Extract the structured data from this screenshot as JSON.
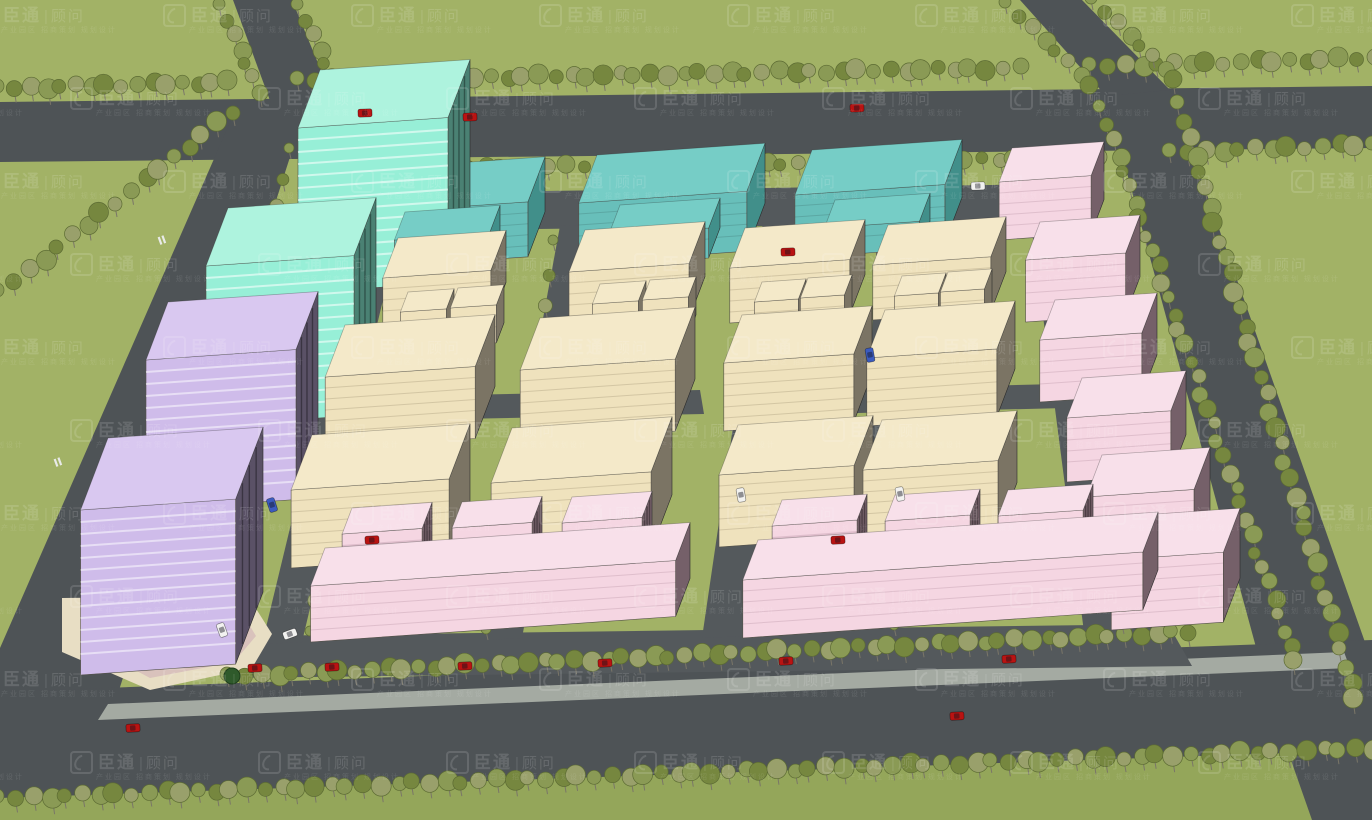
{
  "watermark": {
    "brand": "臣通",
    "divider": "|",
    "suffix": "顾问",
    "tagline": "产业园区 招商策划 规划设计",
    "logo_icon": "swoosh-logo",
    "color": "#ffffff",
    "opacity": 0.13,
    "grid": {
      "x0": -25,
      "y0": 4,
      "dx": 188,
      "dy": 83,
      "cols": 9,
      "rows": 10,
      "row_offset": 95
    }
  },
  "palette": {
    "grass": "#a2b266",
    "grassDark": "#94a65a",
    "road": "#4e5356",
    "roadInner": "#54595c",
    "sidewalk": "#a4aaa2",
    "plaza": "#e8dec4",
    "plazaPath": "#d9c2bc",
    "treeA": "#8a9a55",
    "treeB": "#76873f",
    "treeC": "#99a06b",
    "treeStroke": "#5c6b33",
    "treeDark": "#2f5a2b",
    "carRed": "#b91312",
    "carWhite": "#f2f2f0",
    "carBlue": "#3b5bbf",
    "marking": "#e8eae8"
  },
  "building_palettes": {
    "mint": {
      "top": "#aef3de",
      "front": "#97efd7",
      "side": "#4a8173",
      "line": "rgba(255,255,255,0.55)"
    },
    "teal": {
      "top": "#76cdc6",
      "front": "#68bfba",
      "side": "#418f8a",
      "line": "rgba(0,0,0,0.12)"
    },
    "cream": {
      "top": "#f4e9c9",
      "front": "#efe2bd",
      "side": "#7b7464",
      "line": "rgba(70,58,30,0.16)"
    },
    "pink": {
      "top": "#f8e0ea",
      "front": "#f5d6e2",
      "side": "#756069",
      "line": "rgba(90,50,70,0.14)"
    },
    "purple": {
      "top": "#d9c8f0",
      "front": "#cfbcea",
      "side": "#5a5166",
      "line": "rgba(255,255,255,0.5)"
    }
  },
  "roads": [
    {
      "name": "bottom-grass-strip",
      "fill": "grassDark",
      "pts": [
        [
          0,
          795
        ],
        [
          1372,
          746
        ],
        [
          1372,
          820
        ],
        [
          0,
          820
        ]
      ]
    },
    {
      "name": "top-road",
      "fill": "road",
      "pts": [
        [
          0,
          102
        ],
        [
          1372,
          86
        ],
        [
          1372,
          148
        ],
        [
          0,
          162
        ]
      ]
    },
    {
      "name": "feeder-road-left",
      "fill": "road",
      "pts": [
        [
          233,
          0
        ],
        [
          292,
          0
        ],
        [
          334,
          102
        ],
        [
          272,
          106
        ]
      ]
    },
    {
      "name": "feeder-road-right",
      "fill": "road",
      "pts": [
        [
          1020,
          0
        ],
        [
          1082,
          0
        ],
        [
          1170,
          90
        ],
        [
          1106,
          96
        ]
      ]
    },
    {
      "name": "left-perimeter-road",
      "fill": "road",
      "pts": [
        [
          238,
          104
        ],
        [
          307,
          104
        ],
        [
          112,
          712
        ],
        [
          0,
          714
        ],
        [
          0,
          648
        ]
      ]
    },
    {
      "name": "right-perimeter-road",
      "fill": "road",
      "pts": [
        [
          1106,
          96
        ],
        [
          1170,
          90
        ],
        [
          1372,
          662
        ],
        [
          1372,
          820
        ],
        [
          1312,
          820
        ],
        [
          1272,
          706
        ]
      ]
    },
    {
      "name": "bottom-road",
      "fill": "road",
      "pts": [
        [
          0,
          692
        ],
        [
          1372,
          640
        ],
        [
          1372,
          750
        ],
        [
          0,
          798
        ]
      ]
    },
    {
      "name": "bottom-sidewalk",
      "fill": "sidewalk",
      "pts": [
        [
          108,
          704
        ],
        [
          1344,
          652
        ],
        [
          1350,
          668
        ],
        [
          98,
          720
        ]
      ]
    },
    {
      "name": "inner-top-road",
      "fill": "roadInner",
      "pts": [
        [
          318,
          194
        ],
        [
          1062,
          184
        ],
        [
          1074,
          222
        ],
        [
          308,
          232
        ]
      ]
    },
    {
      "name": "inner-bottom-road",
      "fill": "roadInner",
      "pts": [
        [
          252,
          636
        ],
        [
          1168,
          624
        ],
        [
          1192,
          666
        ],
        [
          228,
          678
        ]
      ]
    },
    {
      "name": "inner-road-v1",
      "fill": "roadInner",
      "pts": [
        [
          362,
          230
        ],
        [
          400,
          228
        ],
        [
          302,
          642
        ],
        [
          262,
          644
        ]
      ]
    },
    {
      "name": "inner-road-v2",
      "fill": "roadInner",
      "pts": [
        [
          560,
          226
        ],
        [
          598,
          224
        ],
        [
          522,
          638
        ],
        [
          484,
          640
        ]
      ]
    },
    {
      "name": "inner-road-v3",
      "fill": "roadInner",
      "pts": [
        [
          763,
          222
        ],
        [
          808,
          220
        ],
        [
          747,
          636
        ],
        [
          702,
          638
        ]
      ]
    },
    {
      "name": "inner-road-v4",
      "fill": "roadInner",
      "pts": [
        [
          878,
          220
        ],
        [
          912,
          219
        ],
        [
          890,
          634
        ],
        [
          856,
          635
        ]
      ]
    },
    {
      "name": "inner-road-v5",
      "fill": "roadInner",
      "pts": [
        [
          1030,
          216
        ],
        [
          1066,
          215
        ],
        [
          1120,
          630
        ],
        [
          1084,
          632
        ]
      ]
    },
    {
      "name": "inner-road-h-left",
      "fill": "roadInner",
      "pts": [
        [
          316,
          398
        ],
        [
          700,
          390
        ],
        [
          704,
          414
        ],
        [
          310,
          422
        ]
      ]
    },
    {
      "name": "inner-road-h-right",
      "fill": "roadInner",
      "pts": [
        [
          740,
          392
        ],
        [
          1058,
          384
        ],
        [
          1066,
          408
        ],
        [
          733,
          416
        ]
      ]
    },
    {
      "name": "plaza",
      "fill": "plaza",
      "pts": [
        [
          62,
          598
        ],
        [
          248,
          596
        ],
        [
          272,
          634
        ],
        [
          252,
          668
        ],
        [
          150,
          690
        ],
        [
          62,
          652
        ]
      ]
    },
    {
      "name": "plaza-path",
      "fill": "plazaPath",
      "pts": [
        [
          90,
          610
        ],
        [
          238,
          606
        ],
        [
          256,
          636
        ],
        [
          234,
          662
        ],
        [
          150,
          678
        ],
        [
          90,
          646
        ]
      ]
    },
    {
      "name": "plaza-lawn",
      "fill": "grass",
      "pts": [
        [
          118,
          620
        ],
        [
          225,
          616
        ],
        [
          240,
          638
        ],
        [
          222,
          656
        ],
        [
          150,
          668
        ],
        [
          116,
          645
        ]
      ]
    }
  ],
  "tree_rows": [
    {
      "x1": 0,
      "y1": 88,
      "x2": 228,
      "y2": 82,
      "n": 16,
      "s": 8
    },
    {
      "x1": 300,
      "y1": 80,
      "x2": 1018,
      "y2": 68,
      "n": 46,
      "s": 8
    },
    {
      "x1": 1092,
      "y1": 66,
      "x2": 1372,
      "y2": 58,
      "n": 18,
      "s": 8
    },
    {
      "x1": 318,
      "y1": 170,
      "x2": 1098,
      "y2": 158,
      "n": 48,
      "s": 7
    },
    {
      "x1": 222,
      "y1": 6,
      "x2": 258,
      "y2": 92,
      "n": 7,
      "s": 7
    },
    {
      "x1": 300,
      "y1": 6,
      "x2": 338,
      "y2": 92,
      "n": 7,
      "s": 7
    },
    {
      "x1": 1008,
      "y1": 4,
      "x2": 1092,
      "y2": 86,
      "n": 8,
      "s": 7
    },
    {
      "x1": 1094,
      "y1": 0,
      "x2": 1176,
      "y2": 80,
      "n": 8,
      "s": 7
    },
    {
      "x1": 1172,
      "y1": 152,
      "x2": 1372,
      "y2": 144,
      "n": 13,
      "s": 8
    },
    {
      "x1": 1102,
      "y1": 108,
      "x2": 1296,
      "y2": 662,
      "n": 36,
      "s": 7
    },
    {
      "x1": 1180,
      "y1": 104,
      "x2": 1356,
      "y2": 700,
      "n": 36,
      "s": 8
    },
    {
      "x1": 0,
      "y1": 292,
      "x2": 232,
      "y2": 112,
      "n": 17,
      "s": 8
    },
    {
      "x1": 292,
      "y1": 150,
      "x2": 162,
      "y2": 606,
      "n": 17,
      "s": 6
    },
    {
      "x1": 230,
      "y1": 676,
      "x2": 1188,
      "y2": 632,
      "n": 62,
      "s": 8
    },
    {
      "x1": 0,
      "y1": 798,
      "x2": 1372,
      "y2": 748,
      "n": 84,
      "s": 8
    },
    {
      "x1": 404,
      "y1": 245,
      "x2": 310,
      "y2": 632,
      "n": 13,
      "s": 6
    },
    {
      "x1": 556,
      "y1": 242,
      "x2": 486,
      "y2": 630,
      "n": 13,
      "s": 6
    },
    {
      "x1": 812,
      "y1": 238,
      "x2": 752,
      "y2": 628,
      "n": 13,
      "s": 6
    },
    {
      "x1": 916,
      "y1": 236,
      "x2": 894,
      "y2": 626,
      "n": 13,
      "s": 6
    },
    {
      "x1": 1070,
      "y1": 232,
      "x2": 1122,
      "y2": 624,
      "n": 13,
      "s": 6
    }
  ],
  "plaza_trees": [
    {
      "x": 140,
      "y": 632,
      "r": 9
    },
    {
      "x": 190,
      "y": 658,
      "r": 9
    },
    {
      "x": 232,
      "y": 676,
      "r": 8
    },
    {
      "x": 108,
      "y": 618,
      "r": 7
    }
  ],
  "buildings": [
    {
      "id": "teal-slab-3",
      "pal": "teal",
      "x": 812,
      "y": 150,
      "w": 150,
      "d": 45,
      "h": 58
    },
    {
      "id": "teal-slab-2",
      "pal": "teal",
      "x": 597,
      "y": 155,
      "w": 168,
      "d": 48,
      "h": 60
    },
    {
      "id": "teal-slab-1",
      "pal": "teal",
      "x": 385,
      "y": 168,
      "w": 160,
      "d": 45,
      "h": 55
    },
    {
      "id": "mint-tower-1",
      "pal": "mint",
      "x": 320,
      "y": 70,
      "w": 150,
      "d": 58,
      "h": 165,
      "tower": true
    },
    {
      "id": "teal-annex-1",
      "pal": "teal",
      "x": 405,
      "y": 212,
      "w": 95,
      "d": 28,
      "h": 28
    },
    {
      "id": "teal-annex-2",
      "pal": "teal",
      "x": 620,
      "y": 205,
      "w": 100,
      "d": 30,
      "h": 30
    },
    {
      "id": "teal-annex-3",
      "pal": "teal",
      "x": 835,
      "y": 200,
      "w": 95,
      "d": 28,
      "h": 28
    },
    {
      "id": "pink-chain-1",
      "pal": "pink",
      "x": 1012,
      "y": 148,
      "w": 92,
      "d": 34,
      "h": 58
    },
    {
      "id": "mint-tower-2",
      "pal": "mint",
      "x": 228,
      "y": 208,
      "w": 148,
      "d": 58,
      "h": 160,
      "tower": true
    },
    {
      "id": "cream-a1",
      "pal": "cream",
      "x": 398,
      "y": 238,
      "w": 108,
      "d": 40,
      "h": 52
    },
    {
      "id": "cream-b1",
      "pal": "cream",
      "x": 585,
      "y": 230,
      "w": 120,
      "d": 42,
      "h": 55
    },
    {
      "id": "cream-c1",
      "pal": "cream",
      "x": 745,
      "y": 228,
      "w": 120,
      "d": 40,
      "h": 55
    },
    {
      "id": "cream-d1",
      "pal": "cream",
      "x": 888,
      "y": 225,
      "w": 118,
      "d": 40,
      "h": 55
    },
    {
      "id": "pink-chain-2",
      "pal": "pink",
      "x": 1040,
      "y": 222,
      "w": 100,
      "d": 38,
      "h": 62
    },
    {
      "id": "cream-cube-a1",
      "pal": "cream",
      "x": 408,
      "y": 292,
      "w": 46,
      "d": 20,
      "h": 38
    },
    {
      "id": "cream-cube-a2",
      "pal": "cream",
      "x": 458,
      "y": 288,
      "w": 46,
      "d": 20,
      "h": 38
    },
    {
      "id": "cream-cube-b1",
      "pal": "cream",
      "x": 600,
      "y": 284,
      "w": 46,
      "d": 20,
      "h": 38
    },
    {
      "id": "cream-cube-b2",
      "pal": "cream",
      "x": 650,
      "y": 280,
      "w": 46,
      "d": 20,
      "h": 38
    },
    {
      "id": "cream-cube-c1",
      "pal": "cream",
      "x": 762,
      "y": 282,
      "w": 44,
      "d": 20,
      "h": 36
    },
    {
      "id": "cream-cube-c2",
      "pal": "cream",
      "x": 808,
      "y": 278,
      "w": 44,
      "d": 20,
      "h": 36
    },
    {
      "id": "cream-cube-d1",
      "pal": "cream",
      "x": 902,
      "y": 276,
      "w": 44,
      "d": 20,
      "h": 36
    },
    {
      "id": "cream-cube-d2",
      "pal": "cream",
      "x": 948,
      "y": 272,
      "w": 44,
      "d": 20,
      "h": 36
    },
    {
      "id": "purple-tower-1",
      "pal": "purple",
      "x": 168,
      "y": 302,
      "w": 150,
      "d": 58,
      "h": 150,
      "tower": true
    },
    {
      "id": "pink-chain-3",
      "pal": "pink",
      "x": 1055,
      "y": 300,
      "w": 102,
      "d": 40,
      "h": 62
    },
    {
      "id": "cream-a2",
      "pal": "cream",
      "x": 345,
      "y": 325,
      "w": 150,
      "d": 52,
      "h": 72
    },
    {
      "id": "cream-b2",
      "pal": "cream",
      "x": 540,
      "y": 318,
      "w": 155,
      "d": 52,
      "h": 72
    },
    {
      "id": "cream-c2",
      "pal": "cream",
      "x": 742,
      "y": 315,
      "w": 130,
      "d": 48,
      "h": 68
    },
    {
      "id": "cream-d2",
      "pal": "cream",
      "x": 885,
      "y": 310,
      "w": 130,
      "d": 48,
      "h": 68
    },
    {
      "id": "pink-chain-4",
      "pal": "pink",
      "x": 1082,
      "y": 378,
      "w": 104,
      "d": 40,
      "h": 64
    },
    {
      "id": "cream-a3",
      "pal": "cream",
      "x": 312,
      "y": 435,
      "w": 158,
      "d": 55,
      "h": 78
    },
    {
      "id": "cream-b3",
      "pal": "cream",
      "x": 512,
      "y": 428,
      "w": 160,
      "d": 55,
      "h": 78
    },
    {
      "id": "cream-c3",
      "pal": "cream",
      "x": 738,
      "y": 425,
      "w": 135,
      "d": 50,
      "h": 72
    },
    {
      "id": "cream-d3",
      "pal": "cream",
      "x": 882,
      "y": 420,
      "w": 135,
      "d": 50,
      "h": 72
    },
    {
      "id": "purple-tower-2",
      "pal": "purple",
      "x": 108,
      "y": 438,
      "w": 155,
      "d": 72,
      "h": 165,
      "tower": true
    },
    {
      "id": "pink-chain-5",
      "pal": "pink",
      "x": 1102,
      "y": 455,
      "w": 108,
      "d": 42,
      "h": 66
    },
    {
      "id": "pink-row-left-tower-1",
      "pal": "pink",
      "x": 352,
      "y": 508,
      "w": 80,
      "d": 26,
      "h": 95,
      "tower": true
    },
    {
      "id": "pink-row-left-tower-2",
      "pal": "pink",
      "x": 462,
      "y": 502,
      "w": 80,
      "d": 26,
      "h": 95,
      "tower": true
    },
    {
      "id": "pink-row-left-tower-3",
      "pal": "pink",
      "x": 572,
      "y": 497,
      "w": 80,
      "d": 26,
      "h": 95,
      "tower": true
    },
    {
      "id": "pink-row-left-base",
      "pal": "pink",
      "x": 325,
      "y": 548,
      "w": 365,
      "d": 38,
      "h": 56
    },
    {
      "id": "pink-row-right-tower-1",
      "pal": "pink",
      "x": 782,
      "y": 500,
      "w": 85,
      "d": 26,
      "h": 95,
      "tower": true
    },
    {
      "id": "pink-row-right-tower-2",
      "pal": "pink",
      "x": 895,
      "y": 495,
      "w": 85,
      "d": 26,
      "h": 95,
      "tower": true
    },
    {
      "id": "pink-row-right-tower-3",
      "pal": "pink",
      "x": 1008,
      "y": 490,
      "w": 85,
      "d": 26,
      "h": 95,
      "tower": true
    },
    {
      "id": "pink-chain-6",
      "pal": "pink",
      "x": 1128,
      "y": 516,
      "w": 112,
      "d": 44,
      "h": 70
    },
    {
      "id": "pink-row-right-base",
      "pal": "pink",
      "x": 758,
      "y": 540,
      "w": 400,
      "d": 40,
      "h": 58
    }
  ],
  "cars": [
    {
      "x": 365,
      "y": 113,
      "c": "carRed",
      "r": -2
    },
    {
      "x": 470,
      "y": 117,
      "c": "carRed",
      "r": -2
    },
    {
      "x": 857,
      "y": 108,
      "c": "carRed",
      "r": -2
    },
    {
      "x": 788,
      "y": 252,
      "c": "carRed",
      "r": -2
    },
    {
      "x": 372,
      "y": 540,
      "c": "carRed",
      "r": -3
    },
    {
      "x": 838,
      "y": 540,
      "c": "carRed",
      "r": -3
    },
    {
      "x": 255,
      "y": 668,
      "c": "carRed",
      "r": -3
    },
    {
      "x": 332,
      "y": 667,
      "c": "carRed",
      "r": -3
    },
    {
      "x": 465,
      "y": 666,
      "c": "carRed",
      "r": -3
    },
    {
      "x": 605,
      "y": 663,
      "c": "carRed",
      "r": -3
    },
    {
      "x": 786,
      "y": 661,
      "c": "carRed",
      "r": -3
    },
    {
      "x": 1009,
      "y": 659,
      "c": "carRed",
      "r": -3
    },
    {
      "x": 133,
      "y": 728,
      "c": "carRed",
      "r": -3
    },
    {
      "x": 957,
      "y": 716,
      "c": "carRed",
      "r": -3
    },
    {
      "x": 978,
      "y": 186,
      "c": "carWhite",
      "r": -2
    },
    {
      "x": 290,
      "y": 634,
      "c": "carWhite",
      "r": -20
    },
    {
      "x": 900,
      "y": 494,
      "c": "carWhite",
      "r": 80
    },
    {
      "x": 741,
      "y": 495,
      "c": "carWhite",
      "r": 80
    },
    {
      "x": 222,
      "y": 630,
      "c": "carWhite",
      "r": 70
    },
    {
      "x": 870,
      "y": 355,
      "c": "carBlue",
      "r": 80
    },
    {
      "x": 272,
      "y": 505,
      "c": "carBlue",
      "r": 72
    }
  ],
  "markings": [
    {
      "x": 162,
      "y": 240,
      "r": 70
    },
    {
      "x": 58,
      "y": 462,
      "r": 70
    },
    {
      "x": 95,
      "y": 588,
      "r": 70
    }
  ]
}
